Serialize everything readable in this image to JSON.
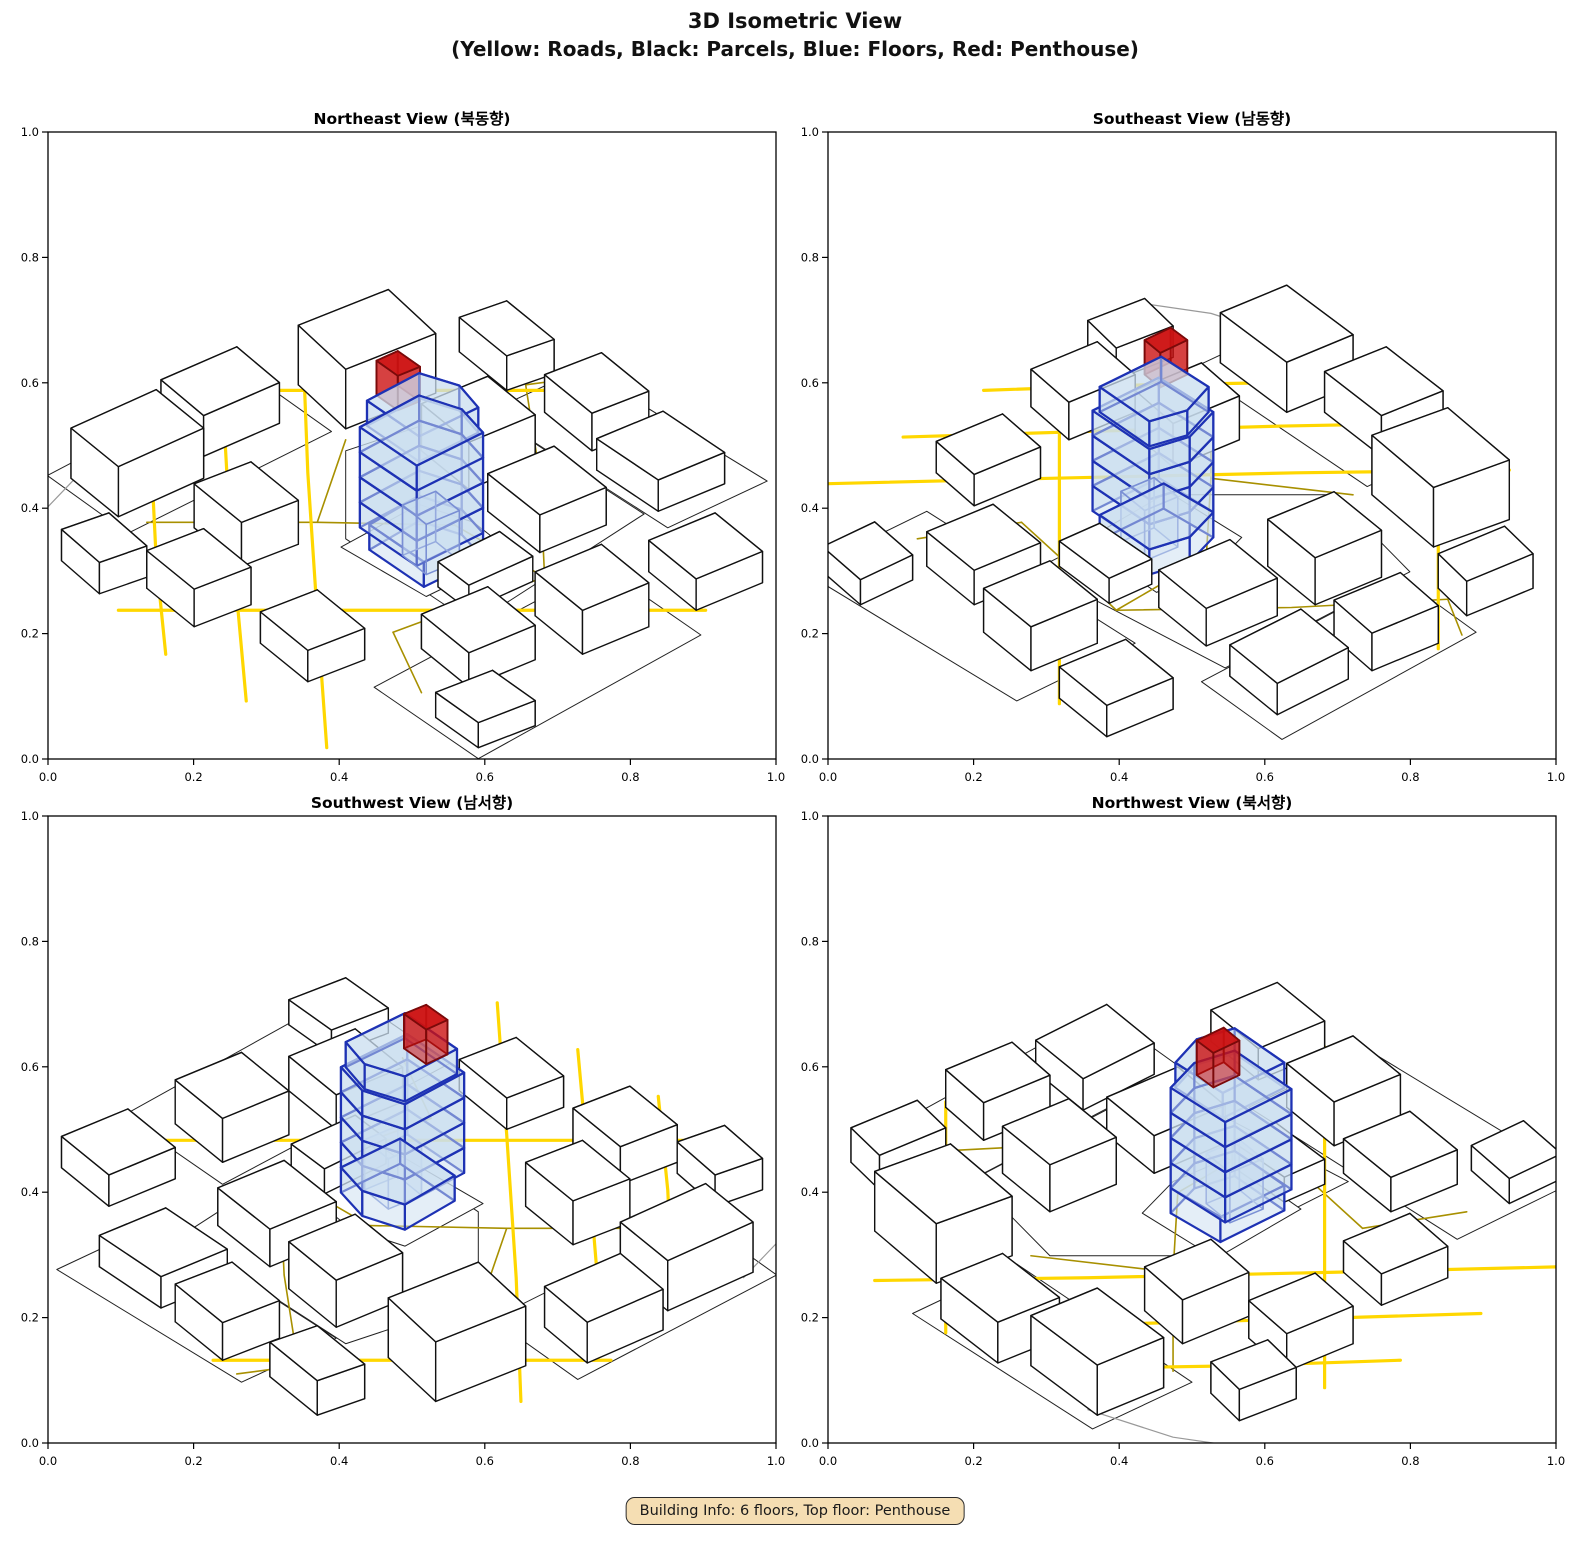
{
  "figure": {
    "title": "3D Isometric View",
    "subtitle": "(Yellow: Roads, Black: Parcels, Blue: Floors, Red: Penthouse)"
  },
  "badge": {
    "text": "Building Info: 6 floors, Top floor: Penthouse",
    "bg": "#F5DEB3",
    "border": "#2B2B2B"
  },
  "building_info": {
    "floors": "6",
    "top_floor": "Penthouse"
  },
  "axes": {
    "tick_labels": [
      "0.0",
      "0.2",
      "0.4",
      "0.6",
      "0.8",
      "1.0"
    ],
    "tick_values": [
      0,
      0.2,
      0.4,
      0.6,
      0.8,
      1.0
    ],
    "xlim": [
      0,
      1
    ],
    "ylim": [
      0,
      1
    ]
  },
  "views": [
    {
      "id": "northeast",
      "title": "Northeast View (북동향)",
      "azimuth_deg": 315
    },
    {
      "id": "southeast",
      "title": "Southeast View (남동향)",
      "azimuth_deg": 45
    },
    {
      "id": "southwest",
      "title": "Southwest View (남서향)",
      "azimuth_deg": 135
    },
    {
      "id": "northwest",
      "title": "Northwest View (북서향)",
      "azimuth_deg": 225
    }
  ],
  "colors": {
    "road_major": "#FFD700",
    "road_minor": "#A89000",
    "boundary": "#999999",
    "parcel_edge": "#222222",
    "parcel_fill": "#FFFFFF",
    "building_edge": "#111111",
    "building_fill": "#FFFFFF",
    "floor_fill": "#C9DEF0",
    "floor_edge": "#1E32B4",
    "core_edge": "#7A8FD4",
    "penthouse_fill": "#CC1111",
    "penthouse_edge": "#7A0A0A"
  },
  "scene": {
    "roads_major": [
      [
        [
          0.02,
          0.37
        ],
        [
          0.2,
          0.57
        ],
        [
          0.4,
          0.79
        ],
        [
          0.55,
          0.95
        ]
      ],
      [
        [
          0.02,
          0.2
        ],
        [
          0.25,
          0.45
        ],
        [
          0.5,
          0.72
        ],
        [
          0.72,
          0.95
        ]
      ],
      [
        [
          0.02,
          0.54
        ],
        [
          0.18,
          0.72
        ],
        [
          0.35,
          0.9
        ]
      ],
      [
        [
          0.05,
          0.67
        ],
        [
          0.35,
          0.37
        ],
        [
          0.67,
          0.05
        ]
      ],
      [
        [
          0.55,
          0.97
        ],
        [
          0.8,
          0.72
        ],
        [
          0.97,
          0.55
        ]
      ]
    ],
    "roads_minor": [
      [
        [
          0.56,
          0.28
        ],
        [
          0.74,
          0.47
        ],
        [
          0.89,
          0.65
        ]
      ],
      [
        [
          0.24,
          0.8
        ],
        [
          0.42,
          0.62
        ],
        [
          0.56,
          0.47
        ]
      ],
      [
        [
          0.3,
          0.34
        ],
        [
          0.48,
          0.3
        ],
        [
          0.56,
          0.28
        ]
      ],
      [
        [
          0.56,
          0.47
        ],
        [
          0.56,
          0.28
        ]
      ],
      [
        [
          0.42,
          0.62
        ],
        [
          0.6,
          0.74
        ]
      ],
      [
        [
          0.89,
          0.65
        ],
        [
          0.97,
          0.6
        ]
      ],
      [
        [
          0.3,
          0.34
        ],
        [
          0.22,
          0.2
        ]
      ]
    ],
    "boundaries": [
      [
        [
          0.02,
          0.86
        ],
        [
          0.12,
          0.92
        ],
        [
          0.26,
          0.96
        ]
      ]
    ],
    "parcels": [
      [
        [
          0.2,
          0.8
        ],
        [
          0.6,
          0.77
        ],
        [
          0.62,
          0.97
        ],
        [
          0.22,
          0.99
        ]
      ],
      [
        [
          0.4,
          0.27
        ],
        [
          0.78,
          0.29
        ],
        [
          0.8,
          0.66
        ],
        [
          0.58,
          0.72
        ],
        [
          0.42,
          0.56
        ]
      ],
      [
        [
          0.78,
          0.24
        ],
        [
          0.97,
          0.22
        ],
        [
          0.98,
          0.62
        ],
        [
          0.8,
          0.64
        ]
      ],
      [
        [
          0.16,
          0.02
        ],
        [
          0.62,
          0.01
        ],
        [
          0.64,
          0.24
        ],
        [
          0.18,
          0.26
        ]
      ],
      [
        [
          0.4,
          0.37
        ],
        [
          0.57,
          0.355
        ],
        [
          0.585,
          0.455
        ],
        [
          0.56,
          0.545
        ],
        [
          0.4,
          0.55
        ]
      ]
    ],
    "buildings": [
      {
        "footprint": [
          [
            0.22,
            0.84
          ],
          [
            0.38,
            0.82
          ],
          [
            0.4,
            0.94
          ],
          [
            0.24,
            0.96
          ]
        ],
        "height": 0.08
      },
      {
        "footprint": [
          [
            0.42,
            0.86
          ],
          [
            0.56,
            0.84
          ],
          [
            0.58,
            0.95
          ],
          [
            0.44,
            0.97
          ]
        ],
        "height": 0.065
      },
      {
        "footprint": [
          [
            0.62,
            0.76
          ],
          [
            0.78,
            0.73
          ],
          [
            0.81,
            0.86
          ],
          [
            0.65,
            0.89
          ]
        ],
        "height": 0.095
      },
      {
        "footprint": [
          [
            0.1,
            0.56
          ],
          [
            0.2,
            0.54
          ],
          [
            0.22,
            0.66
          ],
          [
            0.12,
            0.68
          ]
        ],
        "height": 0.06
      },
      {
        "footprint": [
          [
            0.26,
            0.62
          ],
          [
            0.36,
            0.6
          ],
          [
            0.38,
            0.72
          ],
          [
            0.28,
            0.74
          ]
        ],
        "height": 0.07
      },
      {
        "footprint": [
          [
            0.12,
            0.34
          ],
          [
            0.22,
            0.32
          ],
          [
            0.24,
            0.44
          ],
          [
            0.14,
            0.46
          ]
        ],
        "height": 0.05
      },
      {
        "footprint": [
          [
            0.28,
            0.16
          ],
          [
            0.4,
            0.14
          ],
          [
            0.42,
            0.26
          ],
          [
            0.3,
            0.28
          ]
        ],
        "height": 0.055
      },
      {
        "footprint": [
          [
            0.46,
            0.1
          ],
          [
            0.58,
            0.08
          ],
          [
            0.6,
            0.2
          ],
          [
            0.48,
            0.22
          ]
        ],
        "height": 0.07
      },
      {
        "footprint": [
          [
            0.42,
            0.3
          ],
          [
            0.54,
            0.285
          ],
          [
            0.55,
            0.365
          ],
          [
            0.43,
            0.375
          ]
        ],
        "height": 0.04
      },
      {
        "footprint": [
          [
            0.6,
            0.33
          ],
          [
            0.72,
            0.31
          ],
          [
            0.74,
            0.44
          ],
          [
            0.62,
            0.46
          ]
        ],
        "height": 0.06
      },
      {
        "footprint": [
          [
            0.64,
            0.52
          ],
          [
            0.76,
            0.5
          ],
          [
            0.78,
            0.62
          ],
          [
            0.66,
            0.64
          ]
        ],
        "height": 0.075
      },
      {
        "footprint": [
          [
            0.8,
            0.28
          ],
          [
            0.92,
            0.26
          ],
          [
            0.93,
            0.4
          ],
          [
            0.81,
            0.42
          ]
        ],
        "height": 0.05
      },
      {
        "footprint": [
          [
            0.84,
            0.46
          ],
          [
            0.94,
            0.44
          ],
          [
            0.96,
            0.56
          ],
          [
            0.86,
            0.58
          ]
        ],
        "height": 0.06
      },
      {
        "footprint": [
          [
            0.18,
            0.04
          ],
          [
            0.28,
            0.02
          ],
          [
            0.29,
            0.12
          ],
          [
            0.19,
            0.14
          ]
        ],
        "height": 0.04
      },
      {
        "footprint": [
          [
            0.66,
            0.06
          ],
          [
            0.78,
            0.04
          ],
          [
            0.8,
            0.16
          ],
          [
            0.68,
            0.18
          ]
        ],
        "height": 0.05
      },
      {
        "footprint": [
          [
            0.06,
            0.72
          ],
          [
            0.14,
            0.7
          ],
          [
            0.16,
            0.8
          ],
          [
            0.08,
            0.82
          ]
        ],
        "height": 0.05
      },
      {
        "footprint": [
          [
            0.86,
            0.66
          ],
          [
            0.94,
            0.64
          ],
          [
            0.96,
            0.76
          ],
          [
            0.88,
            0.78
          ]
        ],
        "height": 0.055
      }
    ],
    "target_floors": [
      {
        "footprint": [
          [
            0.415,
            0.39
          ],
          [
            0.53,
            0.38
          ],
          [
            0.55,
            0.445
          ],
          [
            0.53,
            0.515
          ],
          [
            0.425,
            0.515
          ]
        ],
        "z0": 0.0,
        "z1": 0.04
      },
      {
        "footprint": [
          [
            0.4,
            0.39
          ],
          [
            0.53,
            0.38
          ],
          [
            0.55,
            0.445
          ],
          [
            0.53,
            0.515
          ],
          [
            0.41,
            0.52
          ]
        ],
        "z0": 0.04,
        "z1": 0.08
      },
      {
        "footprint": [
          [
            0.4,
            0.39
          ],
          [
            0.53,
            0.38
          ],
          [
            0.55,
            0.445
          ],
          [
            0.53,
            0.515
          ],
          [
            0.41,
            0.52
          ]
        ],
        "z0": 0.08,
        "z1": 0.12
      },
      {
        "footprint": [
          [
            0.4,
            0.39
          ],
          [
            0.53,
            0.38
          ],
          [
            0.55,
            0.445
          ],
          [
            0.53,
            0.515
          ],
          [
            0.41,
            0.52
          ]
        ],
        "z0": 0.12,
        "z1": 0.16
      },
      {
        "footprint": [
          [
            0.4,
            0.39
          ],
          [
            0.53,
            0.38
          ],
          [
            0.55,
            0.445
          ],
          [
            0.53,
            0.515
          ],
          [
            0.41,
            0.52
          ]
        ],
        "z0": 0.16,
        "z1": 0.2
      },
      {
        "footprint": [
          [
            0.41,
            0.395
          ],
          [
            0.525,
            0.385
          ],
          [
            0.545,
            0.445
          ],
          [
            0.525,
            0.51
          ],
          [
            0.42,
            0.515
          ]
        ],
        "z0": 0.2,
        "z1": 0.24
      }
    ],
    "core": {
      "footprint": [
        [
          0.44,
          0.41
        ],
        [
          0.5,
          0.4
        ],
        [
          0.51,
          0.46
        ],
        [
          0.45,
          0.47
        ]
      ],
      "z0": 0.0,
      "z1": 0.08
    },
    "penthouse": {
      "footprint": [
        [
          0.435,
          0.465
        ],
        [
          0.475,
          0.458
        ],
        [
          0.48,
          0.51
        ],
        [
          0.44,
          0.515
        ]
      ],
      "z0": 0.24,
      "z1": 0.295
    }
  }
}
